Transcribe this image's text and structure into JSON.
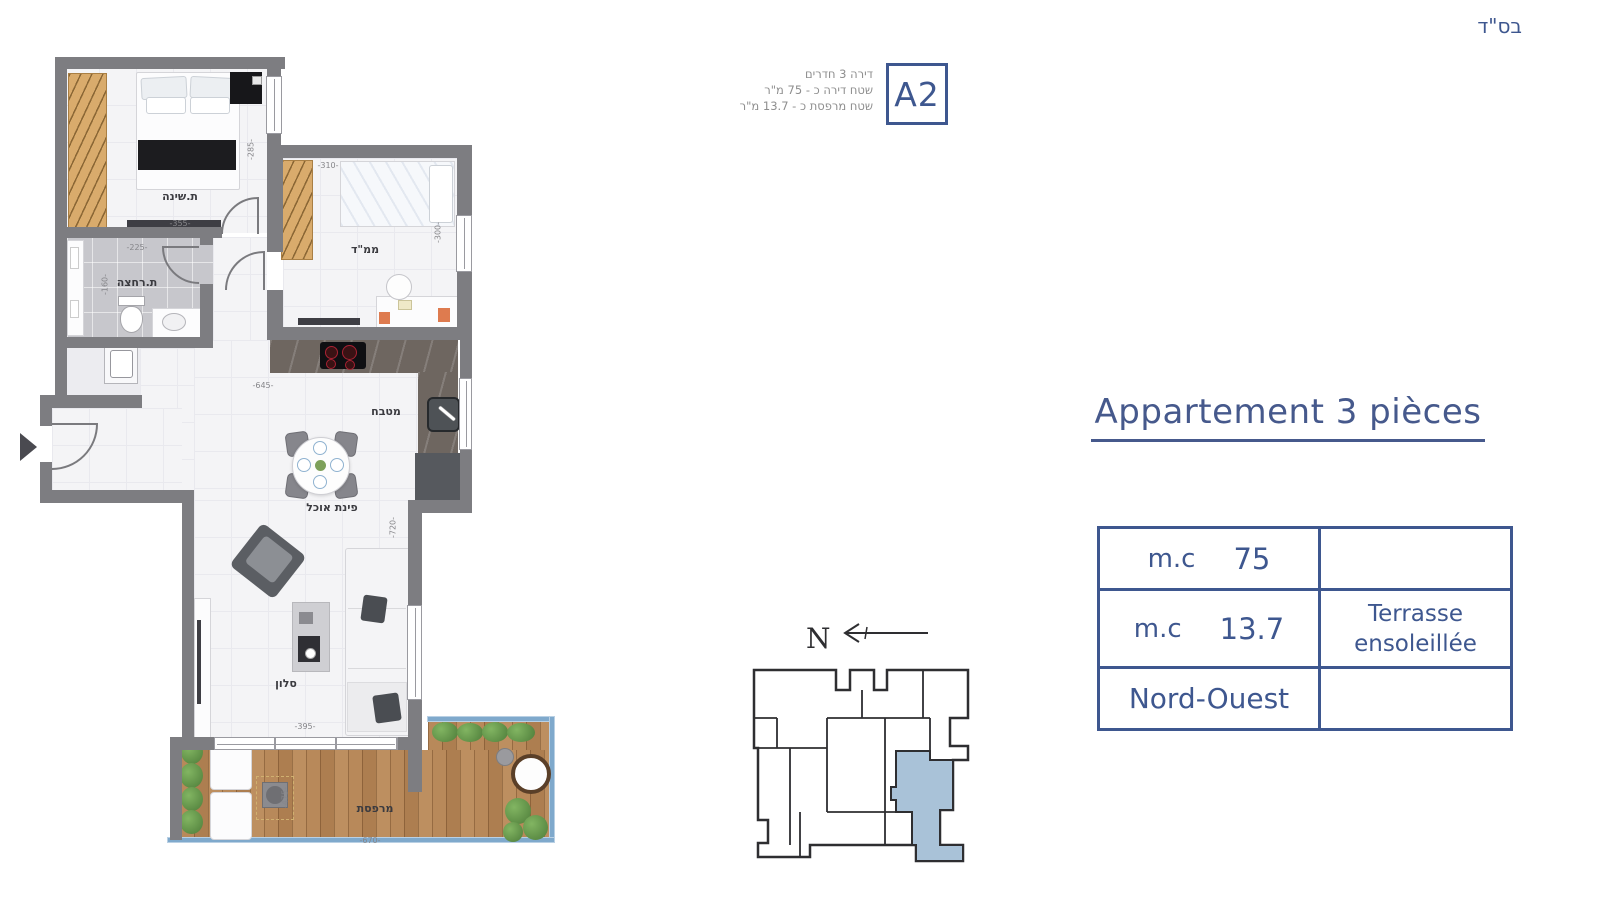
{
  "page": {
    "bsd": "בס\"ד"
  },
  "unit_header": {
    "info_lines": [
      "דירה 3 חדרים",
      "שטח דירה כ - 75 מ\"ר",
      "שטח מרפסת כ - 13.7 מ\"ר"
    ],
    "unit_code": "A2"
  },
  "right_panel": {
    "title": "Appartement 3 pièces",
    "table_rows": [
      {
        "c1a": "m.c",
        "c1b": "75",
        "c2a": "",
        "c2b": ""
      },
      {
        "c1a": "m.c",
        "c1b": "13.7",
        "c2a": "Terrasse",
        "c2b": "ensoleillée"
      },
      {
        "c1a": "Nord-Ouest",
        "c1b": "",
        "c2a": "",
        "c2b": ""
      }
    ]
  },
  "compass": {
    "north_label": "N"
  },
  "floor_plan": {
    "room_labels": {
      "bedroom": "ת.שינה",
      "safe_room": "ממ\"ד",
      "bathroom": "ת.רחצה",
      "kitchen": "מטבח",
      "dining": "פינת אוכל",
      "living": "סלון",
      "terrace": "מרפסת"
    },
    "dimensions": {
      "bedroom_width": "-355-",
      "bedroom_height": "-285-",
      "bathroom_width": "-225-",
      "bathroom_height": "-160-",
      "safe_room_width": "-310-",
      "safe_room_height": "-300-",
      "kitchen_width": "-645-",
      "living_height": "-720-",
      "living_width": "-395-",
      "terrace_height": "-475-",
      "terrace_width": "-670-"
    }
  },
  "colors": {
    "accent_blue": "#3e578f",
    "unit_highlight": "#a9c2d8",
    "wall_gray": "#7d7d81",
    "text_gray": "#8e8e8e"
  }
}
